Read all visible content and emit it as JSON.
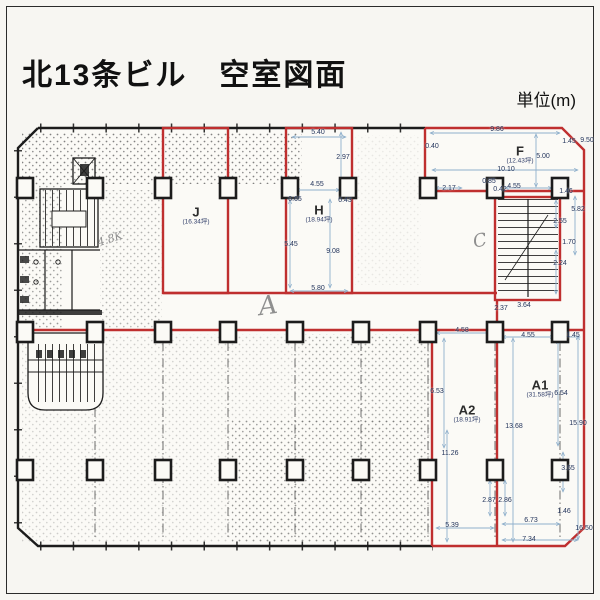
{
  "title": "北13条ビル　空室図面",
  "unit_label": "単位(m)",
  "rooms": [
    {
      "id": "J",
      "area": "(16.34坪)",
      "x": 196,
      "y": 209,
      "ay": 222
    },
    {
      "id": "H",
      "area": "(18.94坪)",
      "x": 319,
      "y": 207,
      "ay": 220
    },
    {
      "id": "F",
      "area": "(12.43坪)",
      "x": 520,
      "y": 148,
      "ay": 161
    },
    {
      "id": "A1",
      "area": "(31.58坪)",
      "x": 540,
      "y": 382,
      "ay": 395
    },
    {
      "id": "A2",
      "area": "(18.91坪)",
      "x": 467,
      "y": 407,
      "ay": 420
    }
  ],
  "annotations": [
    {
      "t": "A",
      "x": 268,
      "y": 306,
      "s": 26,
      "r": -8
    },
    {
      "t": "C",
      "x": 480,
      "y": 241,
      "s": 18,
      "r": -12
    },
    {
      "t": "4.8K",
      "x": 110,
      "y": 239,
      "s": 11,
      "r": -18
    }
  ],
  "dimensions": [
    {
      "t": "9.86",
      "x": 497,
      "y": 130
    },
    {
      "t": "1.45",
      "x": 569,
      "y": 142
    },
    {
      "t": "9.50",
      "x": 587,
      "y": 141
    },
    {
      "t": "0.40",
      "x": 432,
      "y": 147
    },
    {
      "t": "5.00",
      "x": 543,
      "y": 157
    },
    {
      "t": "10.10",
      "x": 506,
      "y": 170
    },
    {
      "t": "0.85",
      "x": 489,
      "y": 182
    },
    {
      "t": "2.17",
      "x": 449,
      "y": 189
    },
    {
      "t": "0.42",
      "x": 500,
      "y": 190
    },
    {
      "t": "4.55",
      "x": 514,
      "y": 187
    },
    {
      "t": "1.46",
      "x": 566,
      "y": 192
    },
    {
      "t": "5.82",
      "x": 578,
      "y": 210
    },
    {
      "t": "2.55",
      "x": 560,
      "y": 222
    },
    {
      "t": "1.70",
      "x": 569,
      "y": 243
    },
    {
      "t": "2.24",
      "x": 560,
      "y": 264
    },
    {
      "t": "3.64",
      "x": 524,
      "y": 306
    },
    {
      "t": "2.37",
      "x": 501,
      "y": 309
    },
    {
      "t": "5.40",
      "x": 318,
      "y": 133
    },
    {
      "t": "2.97",
      "x": 343,
      "y": 158
    },
    {
      "t": "4.55",
      "x": 317,
      "y": 185
    },
    {
      "t": "0.65",
      "x": 295,
      "y": 200
    },
    {
      "t": "0.43",
      "x": 345,
      "y": 201
    },
    {
      "t": "5.45",
      "x": 291,
      "y": 245
    },
    {
      "t": "9.08",
      "x": 333,
      "y": 252
    },
    {
      "t": "5.80",
      "x": 318,
      "y": 289
    },
    {
      "t": "4.58",
      "x": 462,
      "y": 331
    },
    {
      "t": "4.55",
      "x": 528,
      "y": 336
    },
    {
      "t": "1.45",
      "x": 573,
      "y": 336
    },
    {
      "t": "6.53",
      "x": 437,
      "y": 392
    },
    {
      "t": "6.54",
      "x": 561,
      "y": 394
    },
    {
      "t": "13.68",
      "x": 514,
      "y": 427
    },
    {
      "t": "15.90",
      "x": 578,
      "y": 424
    },
    {
      "t": "11.26",
      "x": 450,
      "y": 454
    },
    {
      "t": "3.65",
      "x": 568,
      "y": 469
    },
    {
      "t": "2.87",
      "x": 489,
      "y": 501
    },
    {
      "t": "2.86",
      "x": 505,
      "y": 501
    },
    {
      "t": "6.73",
      "x": 531,
      "y": 521
    },
    {
      "t": "1.46",
      "x": 564,
      "y": 512
    },
    {
      "t": "5.39",
      "x": 452,
      "y": 526
    },
    {
      "t": "16.50",
      "x": 584,
      "y": 529
    },
    {
      "t": "7.34",
      "x": 529,
      "y": 540
    }
  ]
}
